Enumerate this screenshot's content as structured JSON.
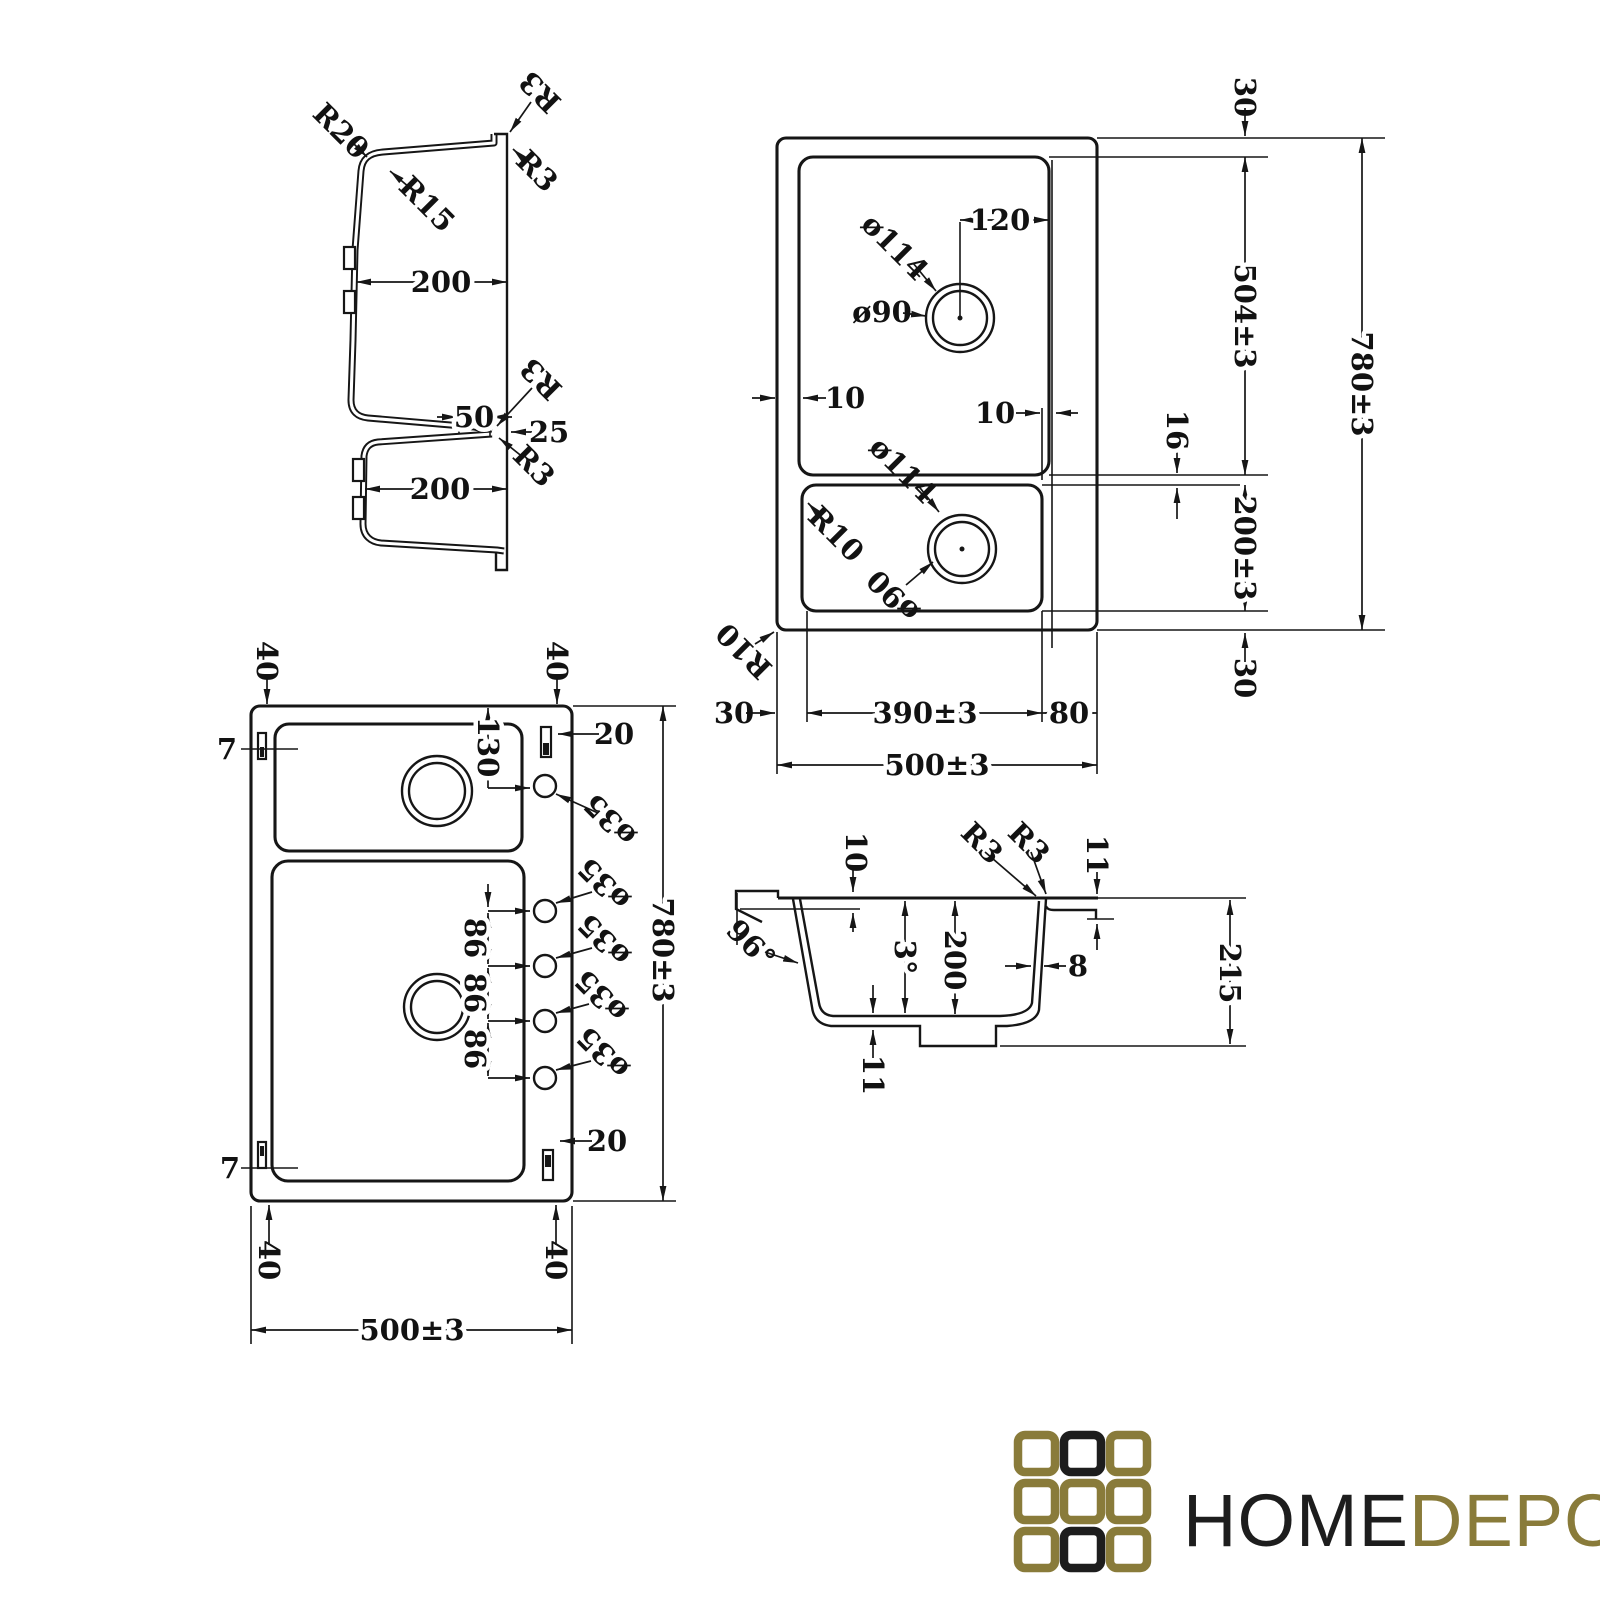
{
  "profile_view": {
    "r20": "R20",
    "r3_top": "R3",
    "r15": "R15",
    "r3_rim": "R3",
    "top_bowl_width": "200",
    "overlap": "50",
    "r3_mid": "R3",
    "rim_offset": "25",
    "r3_low": "R3",
    "bottom_bowl_width": "200"
  },
  "plan_view": {
    "margin_top": "30",
    "drain_offset": "120",
    "drain_outer_top": "ø114",
    "drain_inner_top": "ø90",
    "big_bowl_length": "504±3",
    "overall_length": "780±3",
    "gap_left": "10",
    "gap_right": "10",
    "divider": "16",
    "drain_outer_bottom": "ø114",
    "bowl_corner_radius": "R10",
    "drain_inner_bottom": "ø90",
    "small_bowl_length": "200±3",
    "margin_bottom": "30",
    "outer_corner_radius": "R10",
    "margin_left": "30",
    "bowl_width": "390±3",
    "deck_width": "80",
    "overall_width": "500±3"
  },
  "holes_view": {
    "corner_top_left": "40",
    "corner_top_right": "40",
    "clip_top": "7",
    "clip_right_top": "20",
    "first_hole_offset": "130",
    "hole_diameters": [
      "ø35",
      "ø35",
      "ø35",
      "ø35",
      "ø35"
    ],
    "hole_spacings": [
      "86",
      "86",
      "86"
    ],
    "overall_length": "780±3",
    "clip_right_bottom": "20",
    "clip_bottom": "7",
    "corner_bottom_left": "40",
    "corner_bottom_right": "40",
    "overall_width": "500±3"
  },
  "section_view": {
    "rim_step": "10",
    "r3_inner": "R3",
    "r3_outer": "R3",
    "edge_drop": "11",
    "wall_angle": "96°",
    "draft_angle": "3°",
    "bowl_depth": "200",
    "wall_thickness": "8",
    "overall_depth": "215",
    "base_step": "11"
  },
  "logo": {
    "text_black": "HOME",
    "text_gold": "DEPO",
    "gold": "#897b3a",
    "black": "#1d1d1d"
  }
}
